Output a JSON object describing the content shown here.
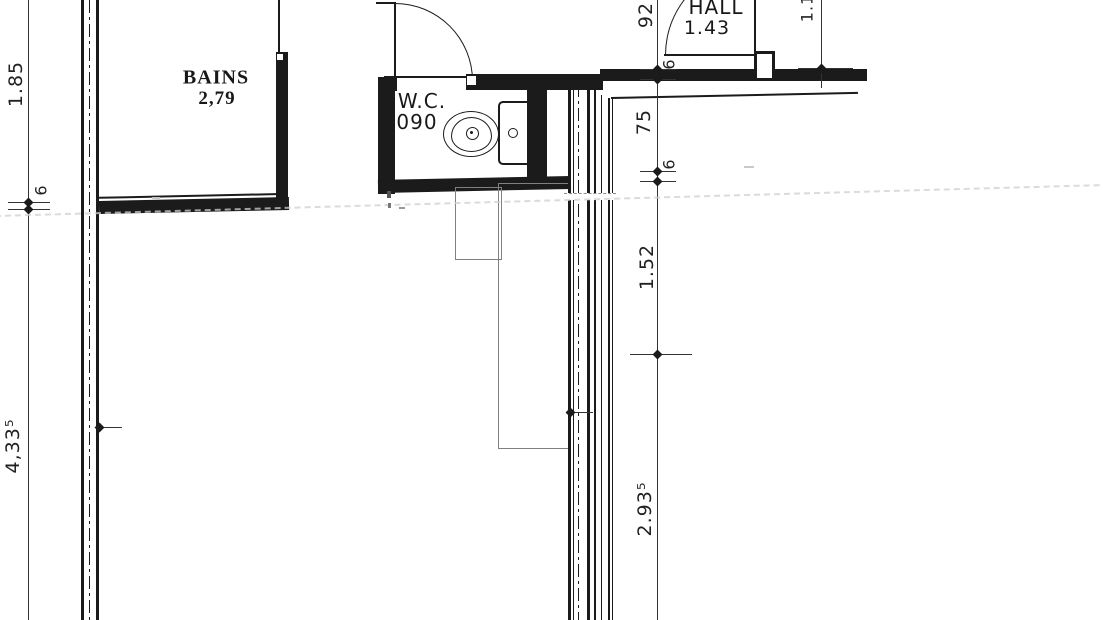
{
  "rooms": {
    "bains": {
      "name": "BAINS",
      "area": "2,79"
    },
    "wc": {
      "name": "W.C.",
      "area": "090"
    },
    "hall": {
      "name": "HALL",
      "area": "1.43"
    }
  },
  "dimensions": {
    "left_upper": "1.85",
    "left_wall_thickness": "6",
    "left_lower": "4,33⁵",
    "center_top": "92",
    "center_wall_top": "6",
    "center_upper": "75",
    "center_wall_mid": "6",
    "center_mid": "1.52",
    "center_lower": "2.93⁵",
    "right_top": "1.1"
  },
  "colors": {
    "ink": "#1b1b1b",
    "dim": "#333333",
    "gray": "#808080",
    "faint": "#cfcfcf",
    "paper": "#ffffff"
  }
}
